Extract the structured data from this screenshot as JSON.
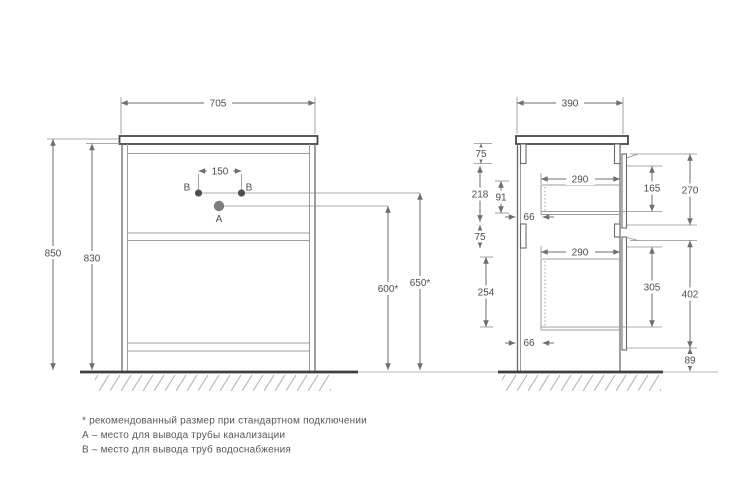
{
  "front": {
    "width": "705",
    "height_total": "850",
    "height_carcass": "830",
    "spacing_b": "150",
    "height_a": "600*",
    "height_b": "650*",
    "point_a": "А",
    "point_b_left": "В",
    "point_b_right": "В"
  },
  "side": {
    "depth": "390",
    "top_rail": "75",
    "upper_section": "218",
    "upper_drawer_height": "91",
    "offset_upper": "66",
    "mid_rail": "75",
    "lower_drawer_height": "254",
    "offset_lower": "66",
    "upper_drawer_depth": "290",
    "lower_drawer_depth": "290",
    "upper_front_inner": "165",
    "upper_front": "270",
    "lower_front_inner": "305",
    "lower_front": "402",
    "bottom_gap": "89"
  },
  "footnotes": [
    "* рекомендованный размер при стандартном подключении",
    "А – место для вывода трубы канализации",
    "В – место для вывода труб водоснабжения"
  ],
  "colors": {
    "line": "#8f8f8f",
    "strong": "#3f3f3f",
    "dim_line": "#6e6e6e",
    "text": "#4d4d4d",
    "point_a": "#7d7d7d",
    "point_b": "#4f4f4f"
  }
}
